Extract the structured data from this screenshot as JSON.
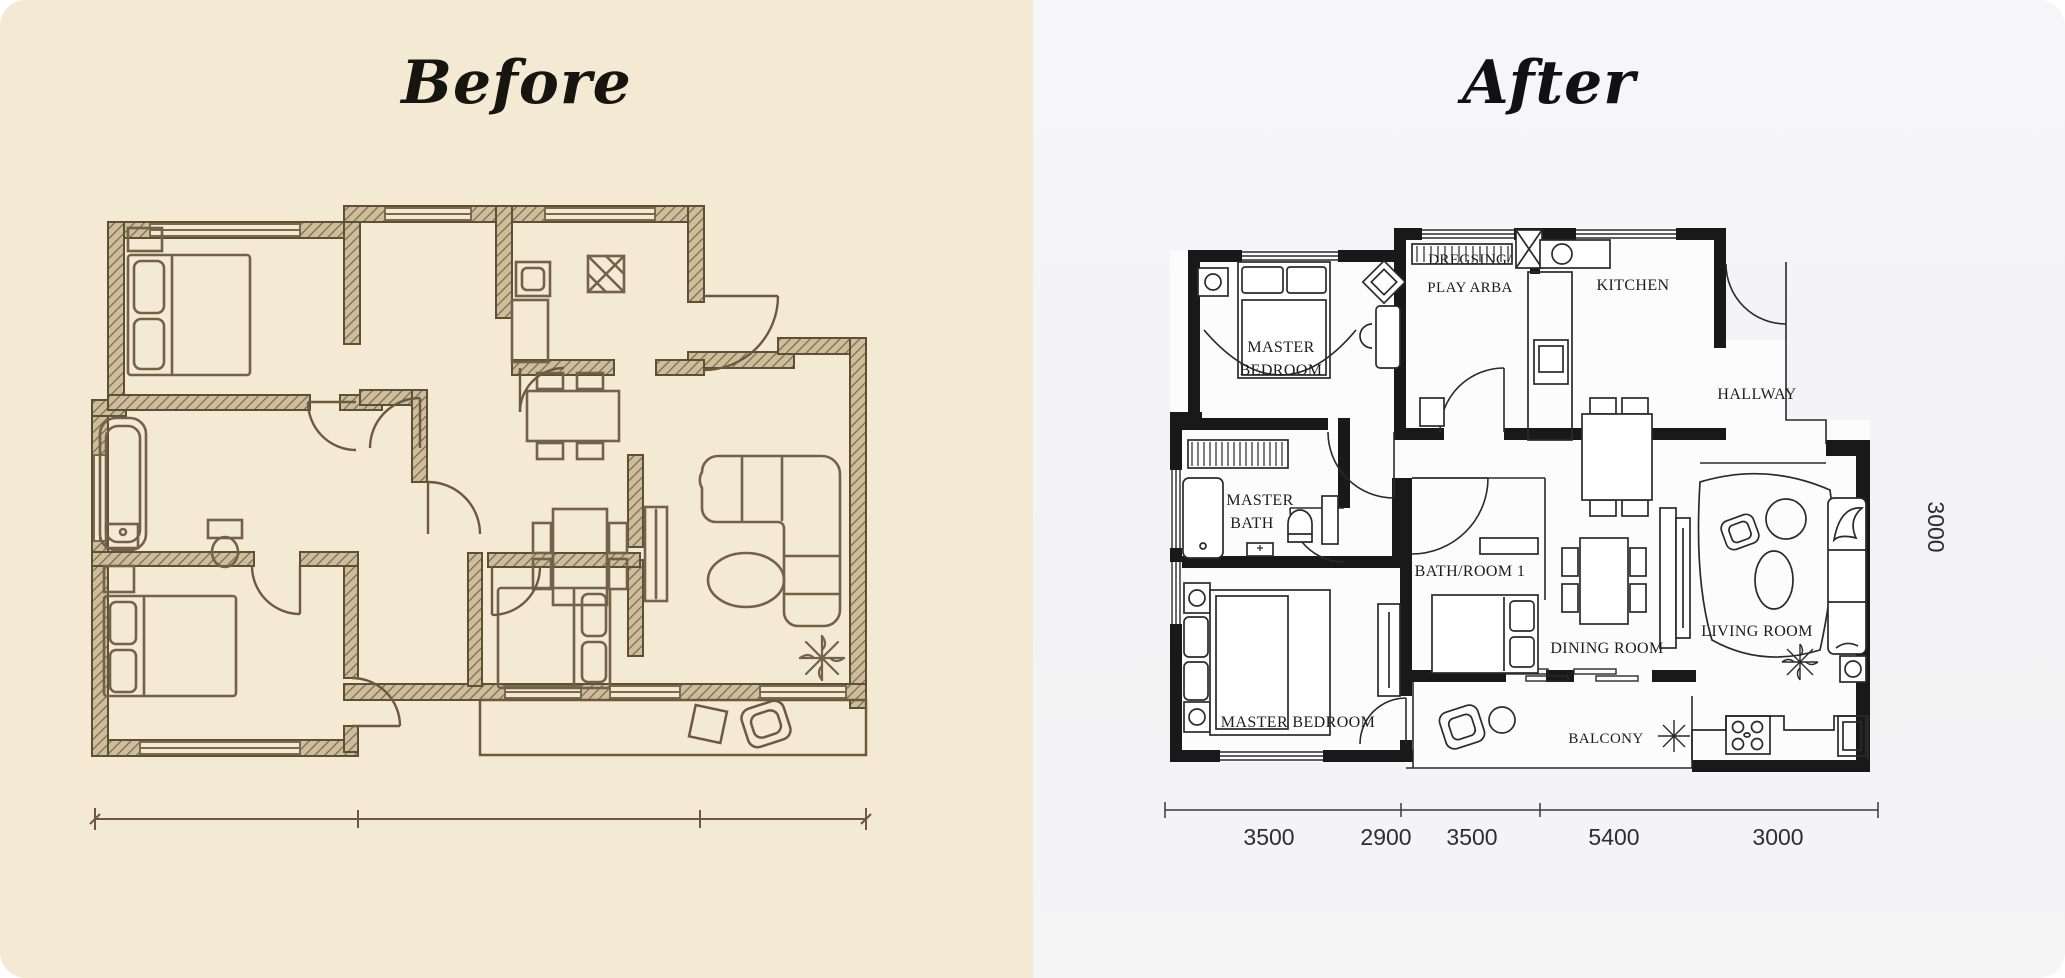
{
  "before": {
    "title": "Before"
  },
  "after": {
    "title": "After",
    "rooms": {
      "dressing_l1": "DREGSING/",
      "dressing_l2": "PLAY ARBA",
      "kitchen": "KITCHEN",
      "master_bedroom_top_l1": "MASTER",
      "master_bedroom_top_l2": "BEDROOM",
      "hallway": "HALLWAY",
      "master_bath_l1": "MASTER",
      "master_bath_l2": "BATH",
      "bathroom1": "BATH/ROOM 1",
      "dining": "DINING ROOM",
      "living": "LIVING ROOM",
      "master_bedroom_bottom": "MASTER BEDROOM",
      "balcony": "BALCONY"
    },
    "dimensions": {
      "bottom": [
        "3500",
        "2900",
        "3500",
        "5400",
        "3000"
      ],
      "side": "3000"
    }
  },
  "colors": {
    "before_background": "#f4e9d3",
    "before_ink": "#5d5039",
    "after_background": "#f5f5f6",
    "after_wall": "#191919",
    "title_ink": "#16150f"
  }
}
